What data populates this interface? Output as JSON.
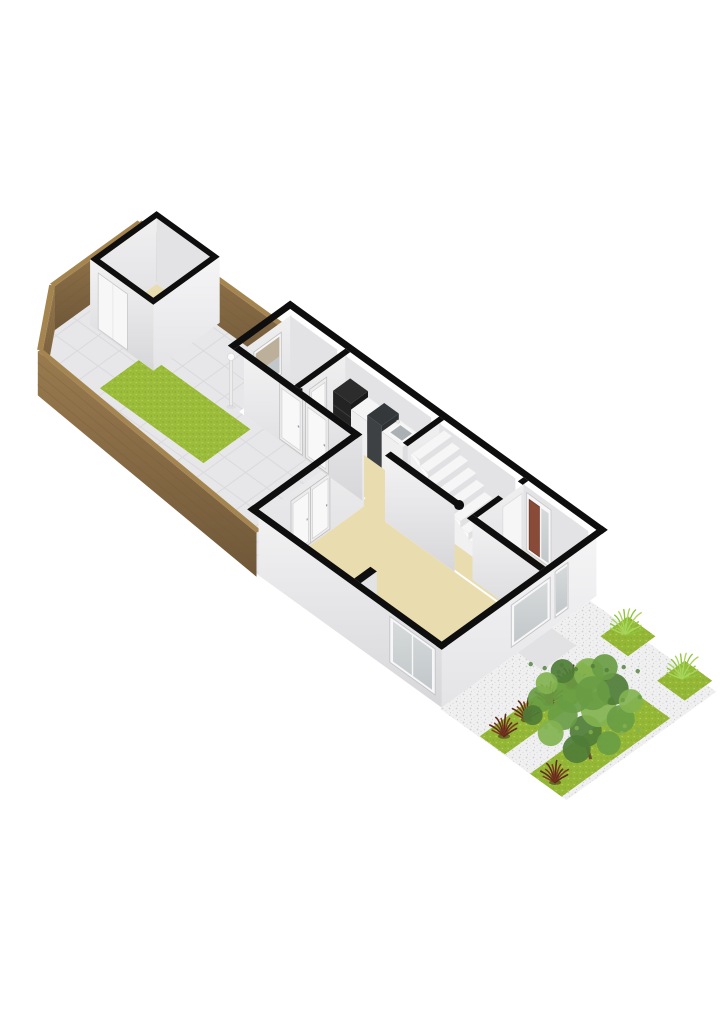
{
  "page": {
    "background": "#ffffff",
    "width": 724,
    "height": 1024
  },
  "palette": {
    "tile": "#e7e7e9",
    "tileGrid": "#dadadc",
    "grassBack": "#9cbc3b",
    "grassFront": "#95b737",
    "grassSpeck1": "#86a82c",
    "grassSpeck2": "#b7cf56",
    "woodTop": "#a5854f",
    "woodHi": "#9a7b4f",
    "woodLo": "#6f5738",
    "beige": "#e9dcae",
    "capBlack": "#0e0e0e",
    "innerHi": "#f0f0f1",
    "innerLo": "#dedee1",
    "sideInner": "#e3e3e6",
    "swHi": "#f3f3f4",
    "swLo": "#d7d7da",
    "seHi": "#f5f5f6",
    "seLo": "#e4e4e7",
    "glassHi": "#d6dadb",
    "glassLo": "#c2c7c9",
    "glassWarm": "#bdb09b",
    "doorWhite": "#f7f7f8",
    "doorFrame": "#c9c9c9",
    "doorBrown": "#8a4a38",
    "counterDark": "#232323",
    "counterDarkTop": "#2c2c2c",
    "counterGray": "#3e4144",
    "counterWhite": "#efeff0",
    "basin": "#aab0b3",
    "gravel": "#f0f0f1",
    "gravelSpeck1": "#cfcfd4",
    "gravelSpeck2": "#dedee2",
    "pad": "#e2e2e4",
    "redPlant1": "#5f2a1b",
    "redPlant2": "#7c3a22",
    "fern1": "#8cc63f",
    "fern2": "#aad45c",
    "tree1": "#4f7d37",
    "tree2": "#699c44",
    "tree3": "#82b250",
    "trunk": "#6b4a2f",
    "white": "#fafafa",
    "stepTop": "#f6f6f7",
    "stepRiser": "#e1e1e4"
  },
  "scene": {
    "projection": {
      "x0": 14,
      "y0": 366,
      "c": 0.81,
      "s": 0.585,
      "wallH": 66,
      "fenceH": 44
    },
    "elements": [
      {
        "type": "terrace",
        "name": "terrace-tiles",
        "pts": [
          [
            -8,
            40
          ],
          [
            55,
            -8
          ],
          [
            163,
            -8
          ],
          [
            163,
            178
          ],
          [
            100,
            178
          ],
          [
            100,
            330
          ],
          [
            -28,
            330
          ]
        ],
        "fill": "tile",
        "grid": 26
      },
      {
        "type": "floor",
        "name": "back-garden-grass",
        "rect": [
          34,
          72,
          92,
          200
        ],
        "fill": "grassBack",
        "pattern": "grassP"
      },
      {
        "type": "fence",
        "name": "fence-north-end",
        "line": [
          [
            55,
            -8
          ],
          [
            163,
            -8
          ]
        ]
      },
      {
        "type": "fence",
        "name": "fence-corner-bevel",
        "line": [
          [
            -8,
            40
          ],
          [
            55,
            -8
          ]
        ]
      },
      {
        "type": "fence",
        "name": "fence-west-side",
        "line": [
          [
            -28,
            330
          ],
          [
            -8,
            40
          ]
        ]
      },
      {
        "type": "fence",
        "name": "fence-northeast-side",
        "line": [
          [
            163,
            -8
          ],
          [
            163,
            178
          ]
        ]
      },
      {
        "type": "shed",
        "name": "garden-shed",
        "rect": [
          82,
          12,
          164,
          90
        ],
        "wt": 6
      },
      {
        "type": "lamp",
        "name": "lamp-post",
        "at": [
          100,
          168
        ]
      },
      {
        "type": "floor",
        "name": "bathroom-floor",
        "rect": [
          104,
          184,
          159,
          242
        ],
        "fill": "beige"
      },
      {
        "type": "floor",
        "name": "kitchen-floor",
        "rect": [
          104,
          252,
          159,
          358
        ],
        "fill": "beige"
      },
      {
        "type": "floor",
        "name": "hallway-floor",
        "rect": [
          98,
          358,
          159,
          552
        ],
        "fill": "beige"
      },
      {
        "type": "floor",
        "name": "living-room-floor",
        "rect": [
          -24,
          336,
          96,
          552
        ],
        "fill": "beige"
      },
      {
        "type": "floor",
        "name": "kitchen-living-connector-floor",
        "rect": [
          92,
          330,
          110,
          362
        ],
        "fill": "beige"
      },
      {
        "type": "face",
        "name": "bathroom-window-wall",
        "line": [
          [
            104,
            184
          ],
          [
            159,
            184
          ]
        ],
        "fill": "gInner"
      },
      {
        "type": "window",
        "name": "bathroom-window",
        "line": [
          [
            112,
            184
          ],
          [
            146,
            184
          ]
        ],
        "h": [
          14,
          56
        ],
        "tint": "warm"
      },
      {
        "type": "face",
        "name": "bathroom-side-wall",
        "line": [
          [
            157,
            184
          ],
          [
            157,
            242
          ]
        ],
        "fill": "sideInner"
      },
      {
        "type": "tub",
        "name": "bathtub",
        "rect": [
          112,
          200,
          152,
          236
        ]
      },
      {
        "type": "face",
        "name": "kitchen-divider-wall",
        "line": [
          [
            104,
            252
          ],
          [
            159,
            252
          ]
        ],
        "fill": "gInner"
      },
      {
        "type": "door",
        "name": "bathroom-door",
        "line": [
          [
            113,
            252
          ],
          [
            134,
            252
          ]
        ],
        "h": [
          2,
          58
        ]
      },
      {
        "type": "face",
        "name": "kitchen-side-wall",
        "line": [
          [
            157,
            252
          ],
          [
            157,
            358
          ]
        ],
        "fill": "sideInner"
      },
      {
        "type": "counter",
        "name": "kitchen-counter",
        "u": [
          140,
          161
        ],
        "units": [
          {
            "v": [
              254,
              276
            ],
            "h": 42,
            "style": "dark"
          },
          {
            "v": [
              276,
              296
            ],
            "h": 36,
            "style": "white"
          },
          {
            "v": [
              296,
              314
            ],
            "h": 42,
            "style": "gray"
          },
          {
            "v": [
              314,
              340
            ],
            "h": 36,
            "style": "sink"
          }
        ]
      },
      {
        "type": "face",
        "name": "stairs-divider-wall",
        "line": [
          [
            118,
            368
          ],
          [
            159,
            368
          ]
        ],
        "fill": "gInner"
      },
      {
        "type": "face",
        "name": "stairs-side-wall",
        "line": [
          [
            157,
            368
          ],
          [
            157,
            462
          ]
        ],
        "fill": "sideInner"
      },
      {
        "type": "stairs",
        "name": "staircase",
        "u": [
          121,
          161
        ],
        "v0": 370,
        "steps": 9,
        "depth": 10,
        "h0": 58,
        "dh": 6.5,
        "stringer": 120
      },
      {
        "type": "face",
        "name": "vestibule-wall",
        "line": [
          [
            104,
            472
          ],
          [
            159,
            472
          ]
        ],
        "fill": "gInner",
        "gap": [
          0.5,
          0.93
        ]
      },
      {
        "type": "face",
        "name": "entry-side-wall",
        "line": [
          [
            157,
            472
          ],
          [
            157,
            552
          ]
        ],
        "fill": "sideInner"
      },
      {
        "type": "frontdoor",
        "name": "front-door",
        "line": [
          [
            157,
            476
          ],
          [
            157,
            506
          ]
        ],
        "h": [
          2,
          60
        ]
      },
      {
        "type": "face",
        "name": "living-room-garden-wall",
        "line": [
          [
            -24,
            336
          ],
          [
            96,
            336
          ]
        ],
        "fill": "gInner"
      },
      {
        "type": "door",
        "name": "terrace-door-left",
        "line": [
          [
            6,
            336
          ],
          [
            30,
            336
          ]
        ],
        "h": [
          2,
          58
        ]
      },
      {
        "type": "door",
        "name": "terrace-door-right",
        "line": [
          [
            30,
            336
          ],
          [
            54,
            336
          ]
        ],
        "h": [
          2,
          58
        ]
      },
      {
        "type": "face",
        "name": "kitchen-outer-wall",
        "line": [
          [
            100,
            184
          ],
          [
            100,
            330
          ]
        ],
        "fill": "gSW"
      },
      {
        "type": "door",
        "name": "garden-door-left",
        "line": [
          [
            100,
            228
          ],
          [
            100,
            256
          ]
        ],
        "h": [
          2,
          58
        ]
      },
      {
        "type": "door",
        "name": "garden-door-right",
        "line": [
          [
            100,
            260
          ],
          [
            100,
            288
          ]
        ],
        "h": [
          2,
          58
        ]
      },
      {
        "type": "face",
        "name": "hall-partition-wall",
        "line": [
          [
            96,
            362
          ],
          [
            96,
            448
          ]
        ],
        "fill": "gSW"
      },
      {
        "type": "face",
        "name": "vestibule-side-wall",
        "line": [
          [
            100,
            466
          ],
          [
            100,
            552
          ]
        ],
        "fill": "gSW"
      },
      {
        "type": "face",
        "name": "living-room-stub-face",
        "line": [
          [
            -28,
            456
          ],
          [
            -8,
            456
          ]
        ],
        "fill": "sideInner"
      },
      {
        "type": "face",
        "name": "southwest-facade",
        "line": [
          [
            -28,
            330
          ],
          [
            -28,
            556
          ]
        ],
        "fill": "gSW"
      },
      {
        "type": "window",
        "name": "living-room-window",
        "line": [
          [
            -28,
            492
          ],
          [
            -28,
            548
          ]
        ],
        "h": [
          8,
          54
        ],
        "mullion": true
      },
      {
        "type": "face",
        "name": "southeast-facade",
        "line": [
          [
            -28,
            556
          ],
          [
            163,
            556
          ]
        ],
        "fill": "gSE"
      },
      {
        "type": "window",
        "name": "facade-window",
        "line": [
          [
            58,
            556
          ],
          [
            106,
            556
          ]
        ],
        "h": [
          10,
          52
        ]
      },
      {
        "type": "window",
        "name": "entry-window",
        "line": [
          [
            112,
            556
          ],
          [
            128,
            556
          ]
        ],
        "h": [
          8,
          54
        ]
      },
      {
        "type": "cap",
        "name": "wall-cap-northwest",
        "rect": [
          93,
          171,
          170,
          178
        ]
      },
      {
        "type": "cap",
        "name": "wall-cap-northeast",
        "rect": [
          163,
          171,
          170,
          563
        ]
      },
      {
        "type": "cap",
        "name": "wall-cap-southeast",
        "rect": [
          -35,
          556,
          170,
          563
        ]
      },
      {
        "type": "cap",
        "name": "wall-cap-southwest",
        "rect": [
          -35,
          323,
          -28,
          563
        ]
      },
      {
        "type": "cap",
        "name": "wall-cap-living-north",
        "rect": [
          -35,
          323,
          100,
          330
        ]
      },
      {
        "type": "cap",
        "name": "wall-cap-kitchen-outer",
        "rect": [
          93,
          178,
          100,
          330
        ]
      },
      {
        "type": "cap",
        "name": "wall-cap-bath-divider",
        "rect": [
          100,
          246,
          163,
          252
        ]
      },
      {
        "type": "cap",
        "name": "wall-cap-stairs-divider",
        "rect": [
          118,
          362,
          163,
          368
        ]
      },
      {
        "type": "capr",
        "name": "wall-cap-hall-partition",
        "rect": [
          96,
          362,
          103,
          448
        ],
        "end": [
          99.5,
          450
        ]
      },
      {
        "type": "cap",
        "name": "wall-cap-vestibule-a",
        "rect": [
          100,
          466,
          132,
          472
        ]
      },
      {
        "type": "cap",
        "name": "wall-cap-vestibule-b",
        "rect": [
          156,
          466,
          163,
          472
        ]
      },
      {
        "type": "cap",
        "name": "wall-cap-vestibule-side",
        "rect": [
          93,
          466,
          100,
          556
        ]
      },
      {
        "type": "cap",
        "name": "living-room-stub-cap",
        "rect": [
          -28,
          448,
          -8,
          456
        ]
      },
      {
        "type": "floor",
        "name": "front-gravel",
        "rect": [
          -30,
          556,
          155,
          712
        ],
        "fill": "gravel",
        "pattern": "gravelP"
      },
      {
        "type": "floor",
        "name": "entrance-pad",
        "rect": [
          66,
          556,
          108,
          586
        ],
        "fill": "pad"
      },
      {
        "type": "floor",
        "name": "grass-square-1",
        "rect": [
          131,
          593,
          165,
          627
        ],
        "fill": "grassFront",
        "pattern": "grassP"
      },
      {
        "type": "floor",
        "name": "grass-square-2",
        "rect": [
          128,
          666,
          162,
          700
        ],
        "fill": "grassFront",
        "pattern": "grassP"
      },
      {
        "type": "floor",
        "name": "grass-strip-1",
        "rect": [
          -29,
          604,
          98,
          635
        ],
        "fill": "grassFront",
        "pattern": "grassP"
      },
      {
        "type": "floor",
        "name": "grass-strip-2",
        "rect": [
          -30,
          667,
          104,
          706
        ],
        "fill": "grassFront",
        "pattern": "grassP"
      },
      {
        "type": "plant",
        "name": "red-plant-1",
        "at": [
          -14,
          619
        ]
      },
      {
        "type": "plant",
        "name": "red-plant-2",
        "at": [
          14,
          619
        ]
      },
      {
        "type": "plant",
        "name": "red-plant-3",
        "at": [
          42,
          619
        ]
      },
      {
        "type": "plant",
        "name": "red-plant-4",
        "at": [
          70,
          619
        ]
      },
      {
        "type": "plant",
        "name": "red-plant-5",
        "at": [
          -22,
          690
        ]
      },
      {
        "type": "fern",
        "name": "fern-plant-1",
        "at": [
          148,
          607
        ]
      },
      {
        "type": "fern",
        "name": "fern-plant-2",
        "at": [
          145,
          680
        ]
      },
      {
        "type": "tree",
        "name": "garden-tree",
        "at": [
          20,
          692
        ]
      }
    ]
  }
}
